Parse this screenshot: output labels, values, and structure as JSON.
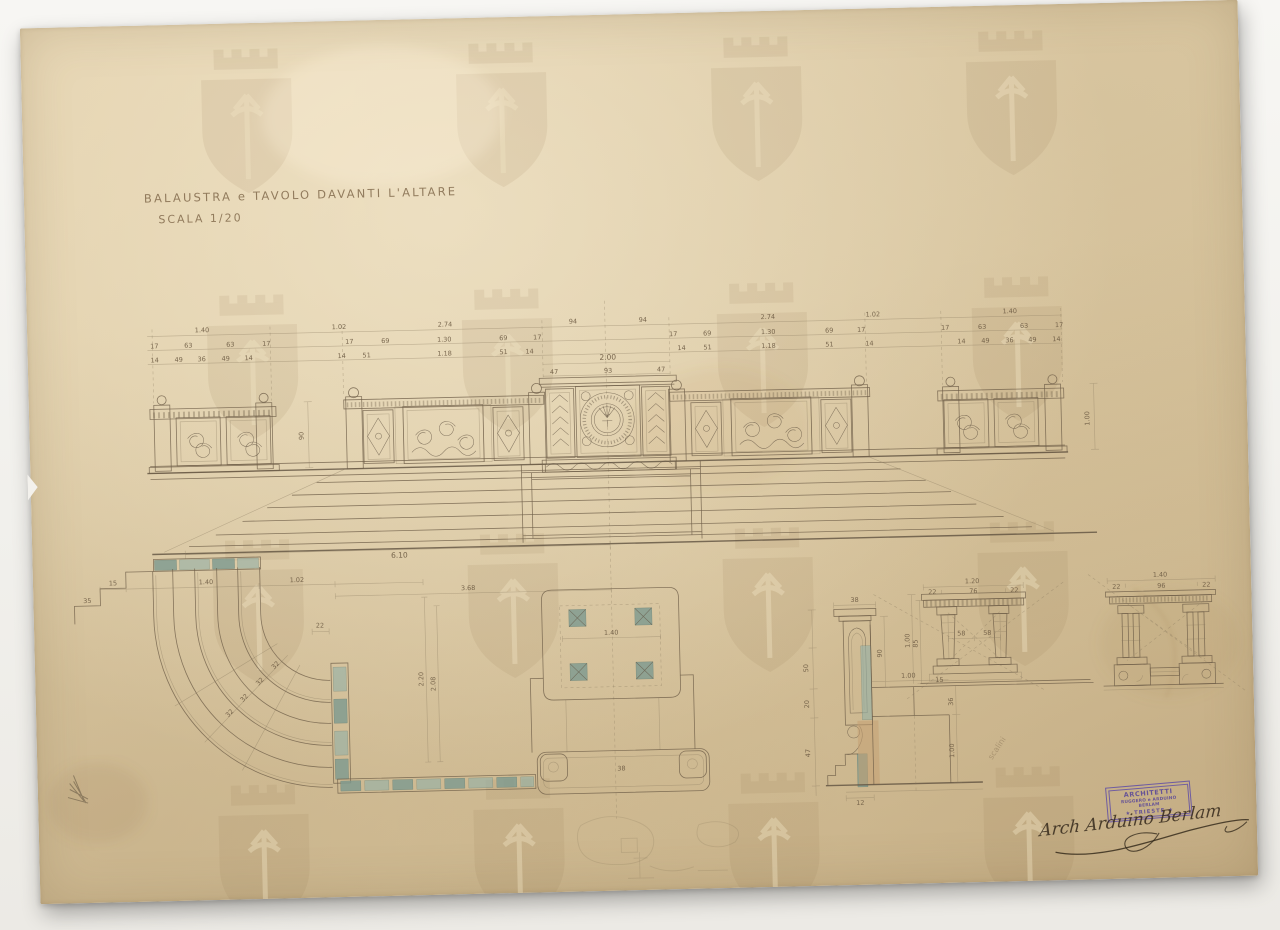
{
  "title_block": {
    "title": "BALAUSTRA e TAVOLO DAVANTI L'ALTARE",
    "scale": "SCALA 1/20"
  },
  "elevation": {
    "row1": [
      "1.40",
      "1.02",
      "2.74",
      "94",
      "94",
      "2.74",
      "1.02",
      "1.40"
    ],
    "row2": [
      "17",
      "63",
      "63",
      "17",
      "17",
      "69",
      "1.30",
      "69",
      "17",
      "17",
      "69",
      "1.30",
      "69",
      "17",
      "17",
      "63",
      "63",
      "17"
    ],
    "row3": [
      "14",
      "49",
      "36",
      "49",
      "14",
      "14",
      "51",
      "1.18",
      "51",
      "14",
      "14",
      "51",
      "1.18",
      "51",
      "14",
      "14",
      "49",
      "36",
      "49",
      "14"
    ],
    "center_total": "2.00",
    "center_parts": [
      "47",
      "93",
      "47"
    ],
    "height": "90",
    "right_height": "1.00",
    "base_width": "6.10"
  },
  "plan": {
    "end_steps": [
      "15",
      "35"
    ],
    "width_a": "1.40",
    "width_b": "1.02",
    "width_c": "3.68",
    "offset": "22",
    "depth_a": "2.20",
    "depth_b": "2.08",
    "tread": "32",
    "table_width": "1.40",
    "base_label": "38"
  },
  "section": {
    "cap_width": "38",
    "d1": "50",
    "d2": "20",
    "d3": "47",
    "height": "90",
    "tread": "1.00",
    "riser": "36",
    "drop": "1.00",
    "base": "12"
  },
  "table_side": {
    "total": "1.20",
    "parts": [
      "22",
      "76",
      "22"
    ],
    "between": [
      "58",
      "58"
    ],
    "plinth": "15",
    "h1": "85",
    "h2": "1.00"
  },
  "table_front": {
    "total": "1.40",
    "parts": [
      "22",
      "96",
      "22"
    ]
  },
  "stamp": {
    "line1": "ARCHITETTI",
    "line2": "RUGGERO e ARDUINO BERLAM",
    "line3": "★ TRIESTE ★"
  },
  "signature": "Arch Arduino Berlam",
  "annotation": "scalini",
  "colors": {
    "paper": "#ddc9a3",
    "ink": "#6b5c46",
    "teal": "#8fafa6",
    "wash": "#c6a277",
    "stamp_purple": "#5a4899"
  }
}
